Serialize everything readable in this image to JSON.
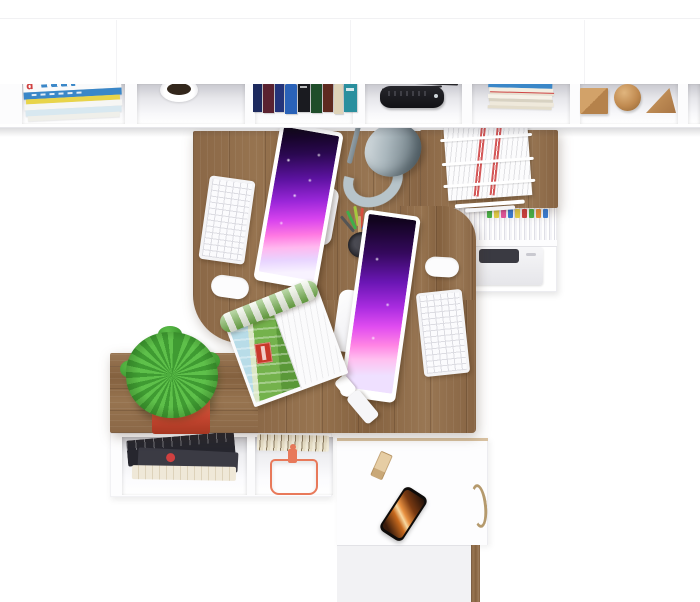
{
  "scene": {
    "title": "Top-down 3D render of a two-person home office workspace",
    "shelf": {
      "magazine_spine_letter": "d",
      "compartments": [
        "stacked magazines",
        "small white pot with dark plant",
        "row of standing books",
        "black speaker with cables",
        "pile of flat magazines",
        "wooden cube, sphere and wedge"
      ]
    },
    "desk": {
      "items": [
        "white keyboard",
        "monitor with purple-pink screensaver",
        "white cable grommet",
        "architect desk lamp",
        "black mesh pencil cup with pencils",
        "second monitor with purple screensaver",
        "second white keyboard",
        "second cable grommet",
        "white usb flash drive",
        "open magazine with farm landscape photo",
        "wire paper tray with documents"
      ]
    },
    "storage": {
      "file_cabinet": [
        "hanging files with colored tabs",
        "white printer"
      ],
      "sideboard": [
        "green fern in red square pot"
      ],
      "bottom_unit": [
        "dark magazine pile",
        "fanned papers",
        "stacked books",
        "white bag with orange handle"
      ],
      "drawer_cabinet": [
        "smartphone with fiery screen",
        "wooden eraser block",
        "bronze drawer handle"
      ]
    }
  },
  "colors": {
    "wood": "#8d6c4a",
    "wood_dark": "#6f523a",
    "wood_light": "#9c7b57",
    "accent_red": "#d04040",
    "accent_blue": "#3a87c8",
    "accent_yellow": "#e8d24a",
    "tab_pink": "#e857a0",
    "tab_green": "#4ab54a",
    "tab_orange": "#e8933a",
    "screen_purple": "#5c12a0",
    "screen_magenta": "#d843ee",
    "screen_pink": "#ff79e2",
    "lamp_base": "#b7c4ca",
    "lamp_gray": "#9aa7ae",
    "plant_green": "#49a437",
    "pot_red": "#d85438",
    "bag_orange": "#e8795a",
    "phone_orange": "#d97a2a",
    "bronze": "#b59a6d"
  }
}
